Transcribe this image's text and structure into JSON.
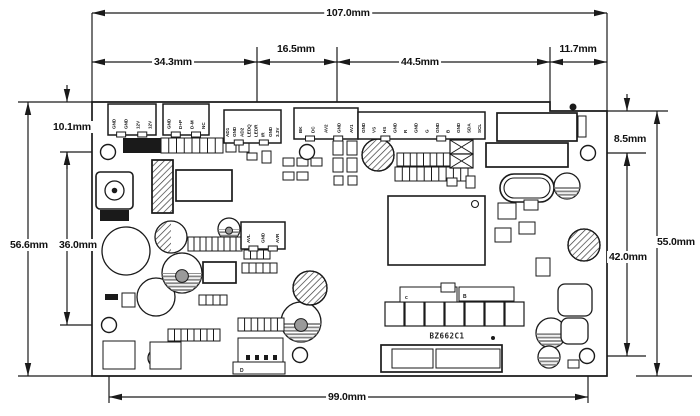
{
  "colors": {
    "line": "#1a1a1a",
    "fill": "#ffffff",
    "stripe": "#808080",
    "hatch": "#3a3a3a"
  },
  "board": {
    "title": "BZ662C1",
    "title_pos": {
      "x": 447,
      "y": 336
    },
    "outline": [
      [
        92,
        102
      ],
      [
        550,
        102
      ],
      [
        550,
        111
      ],
      [
        607,
        111
      ],
      [
        607,
        376
      ],
      [
        92,
        376
      ]
    ],
    "holes": [
      [
        108,
        152
      ],
      [
        307,
        152
      ],
      [
        588,
        153
      ],
      [
        109,
        325
      ],
      [
        300,
        355
      ],
      [
        587,
        356
      ]
    ],
    "hole_radius": 7.5
  },
  "dims": [
    {
      "label": "107.0mm",
      "axis": "h",
      "y": 13,
      "x1": 92,
      "x2": 607,
      "lx": 348,
      "ly": 13
    },
    {
      "label": "34.3mm",
      "axis": "h",
      "y": 62,
      "x1": 92,
      "x2": 257,
      "lx": 173,
      "ly": 62
    },
    {
      "label": "16.5mm",
      "axis": "h",
      "y": 62,
      "x1": 257,
      "x2": 337,
      "lx": 296,
      "ly": 49
    },
    {
      "label": "44.5mm",
      "axis": "h",
      "y": 62,
      "x1": 337,
      "x2": 550,
      "lx": 420,
      "ly": 62
    },
    {
      "label": "11.7mm",
      "axis": "h",
      "y": 62,
      "x1": 550,
      "x2": 607,
      "lx": 578,
      "ly": 49
    },
    {
      "label": "10.1mm",
      "axis": "vo",
      "x": 67,
      "y1": 102,
      "y2": 152,
      "lx": 72,
      "ly": 127
    },
    {
      "label": "56.6mm",
      "axis": "v",
      "x": 28,
      "y1": 102,
      "y2": 376,
      "lx": 29,
      "ly": 245
    },
    {
      "label": "36.0mm",
      "axis": "v",
      "x": 67,
      "y1": 152,
      "y2": 325,
      "lx": 78,
      "ly": 245
    },
    {
      "label": "8.5mm",
      "axis": "vo",
      "x": 627,
      "y1": 111,
      "y2": 153,
      "lx": 630,
      "ly": 139
    },
    {
      "label": "42.0mm",
      "axis": "v",
      "x": 627,
      "y1": 153,
      "y2": 356,
      "lx": 628,
      "ly": 257
    },
    {
      "label": "55.0mm",
      "axis": "v",
      "x": 657,
      "y1": 111,
      "y2": 376,
      "lx": 676,
      "ly": 242
    },
    {
      "label": "99.0mm",
      "axis": "h",
      "y": 397,
      "x1": 109,
      "x2": 588,
      "lx": 347,
      "ly": 397
    }
  ],
  "ext_lines": [
    [
      92,
      13,
      92,
      102
    ],
    [
      607,
      13,
      607,
      111
    ],
    [
      257,
      47,
      257,
      102
    ],
    [
      337,
      47,
      337,
      102
    ],
    [
      550,
      47,
      550,
      111
    ],
    [
      18,
      102,
      92,
      102
    ],
    [
      18,
      376,
      92,
      376
    ],
    [
      60,
      152,
      116,
      152
    ],
    [
      60,
      325,
      117,
      325
    ],
    [
      109,
      333,
      109,
      403
    ],
    [
      588,
      364,
      588,
      403
    ],
    [
      607,
      111,
      668,
      111
    ],
    [
      596,
      153,
      646,
      153
    ],
    [
      595,
      356,
      646,
      356
    ],
    [
      636,
      376,
      692,
      376
    ]
  ],
  "connectors": [
    {
      "n": "power-connector",
      "x": 108,
      "y": 104,
      "w": 48,
      "h": 31,
      "pins": [
        "GND",
        "GND",
        "12V",
        "12V"
      ]
    },
    {
      "n": "usb-connector",
      "x": 163,
      "y": 104,
      "w": 46,
      "h": 31,
      "pins": [
        "GND",
        "D+P",
        "D-M",
        "NC"
      ]
    },
    {
      "n": "key-led-connector",
      "x": 224,
      "y": 110,
      "w": 57,
      "h": 33,
      "pins": [
        "AD1",
        "GND",
        "AD2",
        "LEDQ",
        "LEDR",
        "IR",
        "GND",
        "3.3V"
      ]
    },
    {
      "n": "av-connector",
      "x": 294,
      "y": 108,
      "w": 64,
      "h": 31,
      "pins": [
        "BK",
        "DC",
        "AV2",
        "GND",
        "AV1"
      ]
    },
    {
      "n": "rgb-connector",
      "x": 358,
      "y": 112,
      "w": 127,
      "h": 27,
      "pins": [
        "GND",
        "VS",
        "HS",
        "GND",
        "R",
        "GND",
        "G",
        "GND",
        "B",
        "GND",
        "SDA",
        "SCL"
      ]
    },
    {
      "n": "audio-connector",
      "x": 241,
      "y": 222,
      "w": 44,
      "h": 27,
      "pins": [
        "AVL",
        "GND",
        "AVR"
      ]
    }
  ],
  "labels": [
    {
      "text": "c",
      "x": 405,
      "y": 299,
      "size": 5
    },
    {
      "text": "B",
      "x": 463,
      "y": 298,
      "size": 5
    },
    {
      "text": "D",
      "x": 240,
      "y": 372,
      "size": 5
    }
  ],
  "parts": [
    {
      "t": "rect2",
      "x": 497,
      "y": 113,
      "w": 80,
      "h": 28,
      "n": "lvds-connector"
    },
    {
      "t": "rect2",
      "x": 486,
      "y": 143,
      "w": 82,
      "h": 24,
      "n": "lvds-socket"
    },
    {
      "t": "rect",
      "x": 578,
      "y": 116,
      "w": 8,
      "h": 21
    },
    {
      "t": "blackrect",
      "x": 123,
      "y": 138,
      "w": 38,
      "h": 15
    },
    {
      "t": "pinrow",
      "x": 161,
      "y": 138,
      "w": 62,
      "h": 15,
      "c": 8,
      "n": "pin-header"
    },
    {
      "t": "rect",
      "x": 226,
      "y": 140,
      "w": 10,
      "h": 12
    },
    {
      "t": "rect",
      "x": 239,
      "y": 140,
      "w": 10,
      "h": 12
    },
    {
      "t": "hatchrect",
      "x": 152,
      "y": 160,
      "w": 21,
      "h": 53,
      "n": "heatsink"
    },
    {
      "t": "rect2",
      "x": 176,
      "y": 170,
      "w": 56,
      "h": 31,
      "n": "regulator-ic"
    },
    {
      "t": "dcjack",
      "x": 96,
      "y": 172,
      "w": 37,
      "h": 37,
      "n": "dc-power-jack"
    },
    {
      "t": "blackrect",
      "x": 100,
      "y": 210,
      "w": 29,
      "h": 11
    },
    {
      "t": "ic",
      "x": 388,
      "y": 196,
      "w": 97,
      "h": 69,
      "n": "main-ic"
    },
    {
      "t": "crystal",
      "x": 500,
      "y": 174,
      "w": 54,
      "h": 28,
      "n": "crystal-oscillator"
    },
    {
      "t": "circle",
      "cx": 126,
      "cy": 251,
      "r": 24,
      "n": "electrolytic-capacitor"
    },
    {
      "t": "circle",
      "cx": 156,
      "cy": 297,
      "r": 19,
      "n": "electrolytic-capacitor"
    },
    {
      "t": "halfhatch",
      "cx": 171,
      "cy": 237,
      "r": 16,
      "n": "inductor"
    },
    {
      "t": "trimmer",
      "cx": 182,
      "cy": 273,
      "r": 20,
      "n": "trimmer-potentiometer"
    },
    {
      "t": "trimmer",
      "cx": 301,
      "cy": 322,
      "r": 20,
      "n": "trimmer-potentiometer"
    },
    {
      "t": "trimmer",
      "cx": 229,
      "cy": 229,
      "r": 11,
      "n": "trimmer-potentiometer"
    },
    {
      "t": "hatchcircle",
      "cx": 310,
      "cy": 288,
      "r": 17,
      "n": "inductor"
    },
    {
      "t": "hatchcircle",
      "cx": 378,
      "cy": 155,
      "r": 16,
      "n": "inductor"
    },
    {
      "t": "hatchcircle",
      "cx": 584,
      "cy": 245,
      "r": 16,
      "n": "inductor"
    },
    {
      "t": "stripecircle",
      "cx": 567,
      "cy": 186,
      "r": 13,
      "n": "capacitor"
    },
    {
      "t": "stripecircle",
      "cx": 551,
      "cy": 333,
      "r": 15,
      "n": "capacitor"
    },
    {
      "t": "stripecircle",
      "cx": 549,
      "cy": 357,
      "r": 11,
      "n": "capacitor"
    },
    {
      "t": "circle",
      "cx": 157,
      "cy": 358,
      "r": 9,
      "n": "capacitor"
    },
    {
      "t": "roundrect",
      "x": 558,
      "y": 284,
      "w": 34,
      "h": 32
    },
    {
      "t": "roundrect",
      "x": 561,
      "y": 318,
      "w": 27,
      "h": 26
    },
    {
      "t": "pinrow",
      "x": 188,
      "y": 237,
      "w": 54,
      "h": 14,
      "c": 9,
      "n": "resistor-array"
    },
    {
      "t": "pinrow",
      "x": 244,
      "y": 250,
      "w": 26,
      "h": 9,
      "c": 4
    },
    {
      "t": "pinrow",
      "x": 242,
      "y": 263,
      "w": 35,
      "h": 10,
      "c": 5
    },
    {
      "t": "rect2",
      "x": 203,
      "y": 262,
      "w": 33,
      "h": 21
    },
    {
      "t": "pinrow",
      "x": 199,
      "y": 295,
      "w": 28,
      "h": 10,
      "c": 4
    },
    {
      "t": "pinrow",
      "x": 238,
      "y": 318,
      "w": 46,
      "h": 13,
      "c": 7,
      "n": "resistor-array"
    },
    {
      "t": "pinrow",
      "x": 168,
      "y": 329,
      "w": 52,
      "h": 12,
      "c": 8,
      "n": "resistor-array"
    },
    {
      "t": "pinrow",
      "x": 397,
      "y": 153,
      "w": 53,
      "h": 13,
      "c": 8
    },
    {
      "t": "pinrow",
      "x": 395,
      "y": 167,
      "w": 73,
      "h": 14,
      "c": 10
    },
    {
      "t": "xbox",
      "x": 450,
      "y": 140,
      "w": 23,
      "h": 14
    },
    {
      "t": "xbox",
      "x": 450,
      "y": 154,
      "w": 23,
      "h": 14
    },
    {
      "t": "sqrow",
      "x": 385,
      "y": 302,
      "c": 7,
      "cw": 19,
      "ch": 24,
      "n": "mosfet-row"
    },
    {
      "t": "rect",
      "x": 400,
      "y": 287,
      "w": 57,
      "h": 15
    },
    {
      "t": "rect",
      "x": 459,
      "y": 287,
      "w": 55,
      "h": 14
    },
    {
      "t": "rect",
      "x": 238,
      "y": 338,
      "w": 45,
      "h": 24,
      "n": "output-connector"
    },
    {
      "t": "rect",
      "x": 233,
      "y": 362,
      "w": 52,
      "h": 12
    },
    {
      "t": "blackrect",
      "x": 246,
      "y": 355,
      "w": 4,
      "h": 5
    },
    {
      "t": "blackrect",
      "x": 255,
      "y": 355,
      "w": 4,
      "h": 5
    },
    {
      "t": "blackrect",
      "x": 264,
      "y": 355,
      "w": 4,
      "h": 5
    },
    {
      "t": "blackrect",
      "x": 273,
      "y": 355,
      "w": 4,
      "h": 5
    },
    {
      "t": "rect2",
      "x": 381,
      "y": 345,
      "w": 121,
      "h": 27,
      "n": "edge-connector"
    },
    {
      "t": "rect",
      "x": 392,
      "y": 349,
      "w": 41,
      "h": 19
    },
    {
      "t": "rect",
      "x": 436,
      "y": 349,
      "w": 64,
      "h": 19
    },
    {
      "t": "rect",
      "x": 103,
      "y": 341,
      "w": 32,
      "h": 28
    },
    {
      "t": "rect",
      "x": 150,
      "y": 342,
      "w": 31,
      "h": 27
    },
    {
      "t": "blackrect",
      "x": 105,
      "y": 294,
      "w": 13,
      "h": 6
    },
    {
      "t": "rect",
      "x": 122,
      "y": 293,
      "w": 13,
      "h": 14
    },
    {
      "t": "rect",
      "x": 262,
      "y": 151,
      "w": 9,
      "h": 12
    },
    {
      "t": "rect",
      "x": 247,
      "y": 153,
      "w": 10,
      "h": 7
    },
    {
      "t": "rect",
      "x": 283,
      "y": 158,
      "w": 11,
      "h": 8
    },
    {
      "t": "rect",
      "x": 297,
      "y": 158,
      "w": 11,
      "h": 8
    },
    {
      "t": "rect",
      "x": 311,
      "y": 158,
      "w": 11,
      "h": 8
    },
    {
      "t": "rect",
      "x": 283,
      "y": 172,
      "w": 11,
      "h": 8
    },
    {
      "t": "rect",
      "x": 297,
      "y": 172,
      "w": 11,
      "h": 8
    },
    {
      "t": "rect",
      "x": 333,
      "y": 141,
      "w": 10,
      "h": 14
    },
    {
      "t": "rect",
      "x": 347,
      "y": 141,
      "w": 10,
      "h": 14
    },
    {
      "t": "rect",
      "x": 333,
      "y": 158,
      "w": 10,
      "h": 14
    },
    {
      "t": "rect",
      "x": 347,
      "y": 158,
      "w": 10,
      "h": 14
    },
    {
      "t": "rect",
      "x": 334,
      "y": 176,
      "w": 9,
      "h": 9
    },
    {
      "t": "rect",
      "x": 348,
      "y": 176,
      "w": 9,
      "h": 9
    },
    {
      "t": "rect",
      "x": 447,
      "y": 178,
      "w": 10,
      "h": 8
    },
    {
      "t": "rect",
      "x": 466,
      "y": 176,
      "w": 9,
      "h": 12
    },
    {
      "t": "rect",
      "x": 498,
      "y": 203,
      "w": 18,
      "h": 16
    },
    {
      "t": "rect",
      "x": 524,
      "y": 200,
      "w": 14,
      "h": 10
    },
    {
      "t": "rect",
      "x": 519,
      "y": 222,
      "w": 16,
      "h": 12
    },
    {
      "t": "rect",
      "x": 536,
      "y": 258,
      "w": 14,
      "h": 18
    },
    {
      "t": "rect",
      "x": 495,
      "y": 228,
      "w": 16,
      "h": 14
    },
    {
      "t": "rect",
      "x": 441,
      "y": 283,
      "w": 14,
      "h": 9
    },
    {
      "t": "rect",
      "x": 568,
      "y": 360,
      "w": 11,
      "h": 8
    },
    {
      "t": "blackdot",
      "cx": 573,
      "cy": 107,
      "r": 3.5,
      "n": "fiducial-mark"
    },
    {
      "t": "blackdot",
      "cx": 493,
      "cy": 338,
      "r": 2
    }
  ]
}
